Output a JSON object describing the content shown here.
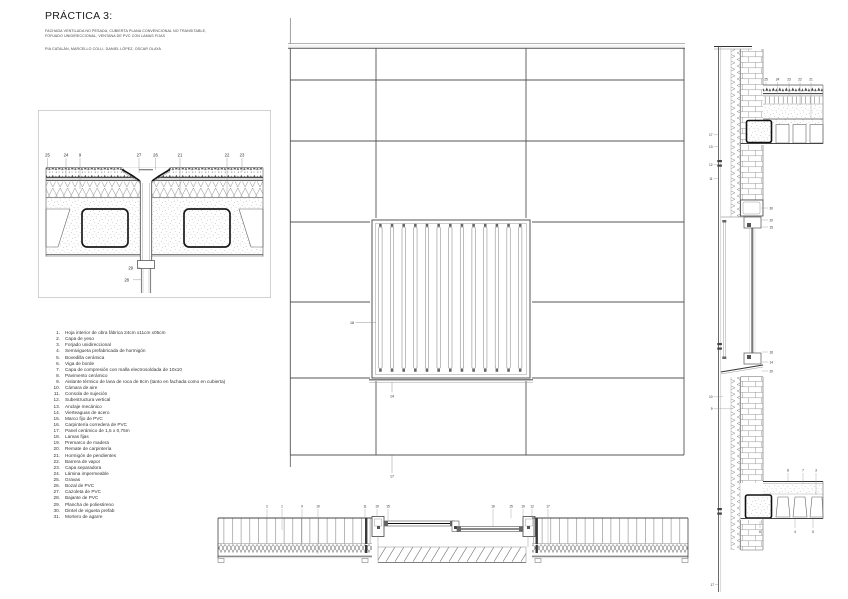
{
  "header": {
    "title": "PRÁCTICA 3:",
    "subtitle_line1": "FACHADA VENTILADA NO PESADA, CUBIERTA PLANA CONVENCIONAL NO TRANSITABLE,",
    "subtitle_line2": "FORJADO UNIDIRECCIONAL, VENTANA DE PVC CON LAMAS FIJAS",
    "team": "PIA CATALÁN, MARCELLO COLLI, DANIEL LÓPEZ, OSCAR OLAYA"
  },
  "legend": {
    "items": [
      {
        "num": "1.",
        "text": "Hoja interior de obra fábrica 24cm x11cm x05cm"
      },
      {
        "num": "2.",
        "text": "Capa de yeso"
      },
      {
        "num": "3.",
        "text": "Forjado unidireccional"
      },
      {
        "num": "4.",
        "text": "Semivigueta prefabricada de hormigón"
      },
      {
        "num": "5.",
        "text": "Bovedilla cerámica"
      },
      {
        "num": "6.",
        "text": "Viga de borde"
      },
      {
        "num": "7.",
        "text": "Capa de compresión con malla electrosoldada de 10x10"
      },
      {
        "num": "8.",
        "text": "Pavimento cerámico"
      },
      {
        "num": "9.",
        "text": "Aislante térmico de lana de roca de 8cm (tanto en fachada como en cubierta)"
      },
      {
        "num": "10.",
        "text": "Cámara de aire"
      },
      {
        "num": "11.",
        "text": "Consola de sujeción"
      },
      {
        "num": "12.",
        "text": "Subestructura vertical"
      },
      {
        "num": "13.",
        "text": "Anclaje mecánico"
      },
      {
        "num": "14.",
        "text": "Vierteaguas de acero"
      },
      {
        "num": "15.",
        "text": "Marco fijo de PVC"
      },
      {
        "num": "16.",
        "text": "Carpintería corredera de PVC"
      },
      {
        "num": "17.",
        "text": "Panel cerámico de 1,5 x 0,75m"
      },
      {
        "num": "18.",
        "text": "Lamas fijas"
      },
      {
        "num": "19.",
        "text": "Premarco de madera"
      },
      {
        "num": "20.",
        "text": "Remate de carpintería"
      },
      {
        "num": "21.",
        "text": "Hormigón de pendientes"
      },
      {
        "num": "22.",
        "text": "Barrera de vapor"
      },
      {
        "num": "23.",
        "text": "Capa separadora"
      },
      {
        "num": "24.",
        "text": "Lámina impermeable"
      },
      {
        "num": "25.",
        "text": "Gravas"
      },
      {
        "num": "26.",
        "text": "Bozal de PVC"
      },
      {
        "num": "27.",
        "text": "Cazoleta de PVC"
      },
      {
        "num": "28.",
        "text": "Bajante de PVC"
      },
      {
        "num": "29.",
        "text": "Plancha de poliestireno"
      },
      {
        "num": "30.",
        "text": "Dintel de vigueta prefab"
      },
      {
        "num": "31.",
        "text": "Mortero de agarre"
      }
    ]
  },
  "drawings": {
    "roof_drain_detail": {
      "callouts_top": [
        "25",
        "24",
        "9",
        "27",
        "26",
        "21",
        "22",
        "23"
      ],
      "callouts_bottom": [
        "29",
        "28"
      ]
    },
    "elevation": {
      "callouts": [
        "18",
        "14",
        "17"
      ]
    },
    "plan_section": {
      "callouts": [
        "2",
        "1",
        "9",
        "10",
        "11",
        "19",
        "15",
        "16",
        "15",
        "19",
        "12",
        "17"
      ]
    },
    "wall_section": {
      "callouts": {
        "roof": [
          "25",
          "24",
          "23",
          "22",
          "21"
        ],
        "left": [
          "17",
          "13",
          "12",
          "11",
          "10",
          "9",
          "17"
        ],
        "head": [
          "30",
          "20",
          "15"
        ],
        "sill": [
          "16",
          "14",
          "20"
        ],
        "floor_above": [
          "8",
          "7",
          "3"
        ],
        "floor_below": [
          "6",
          "4",
          "5"
        ]
      }
    }
  },
  "colors": {
    "line": "#555555",
    "dark": "#1a1a1a",
    "background": "#ffffff"
  }
}
